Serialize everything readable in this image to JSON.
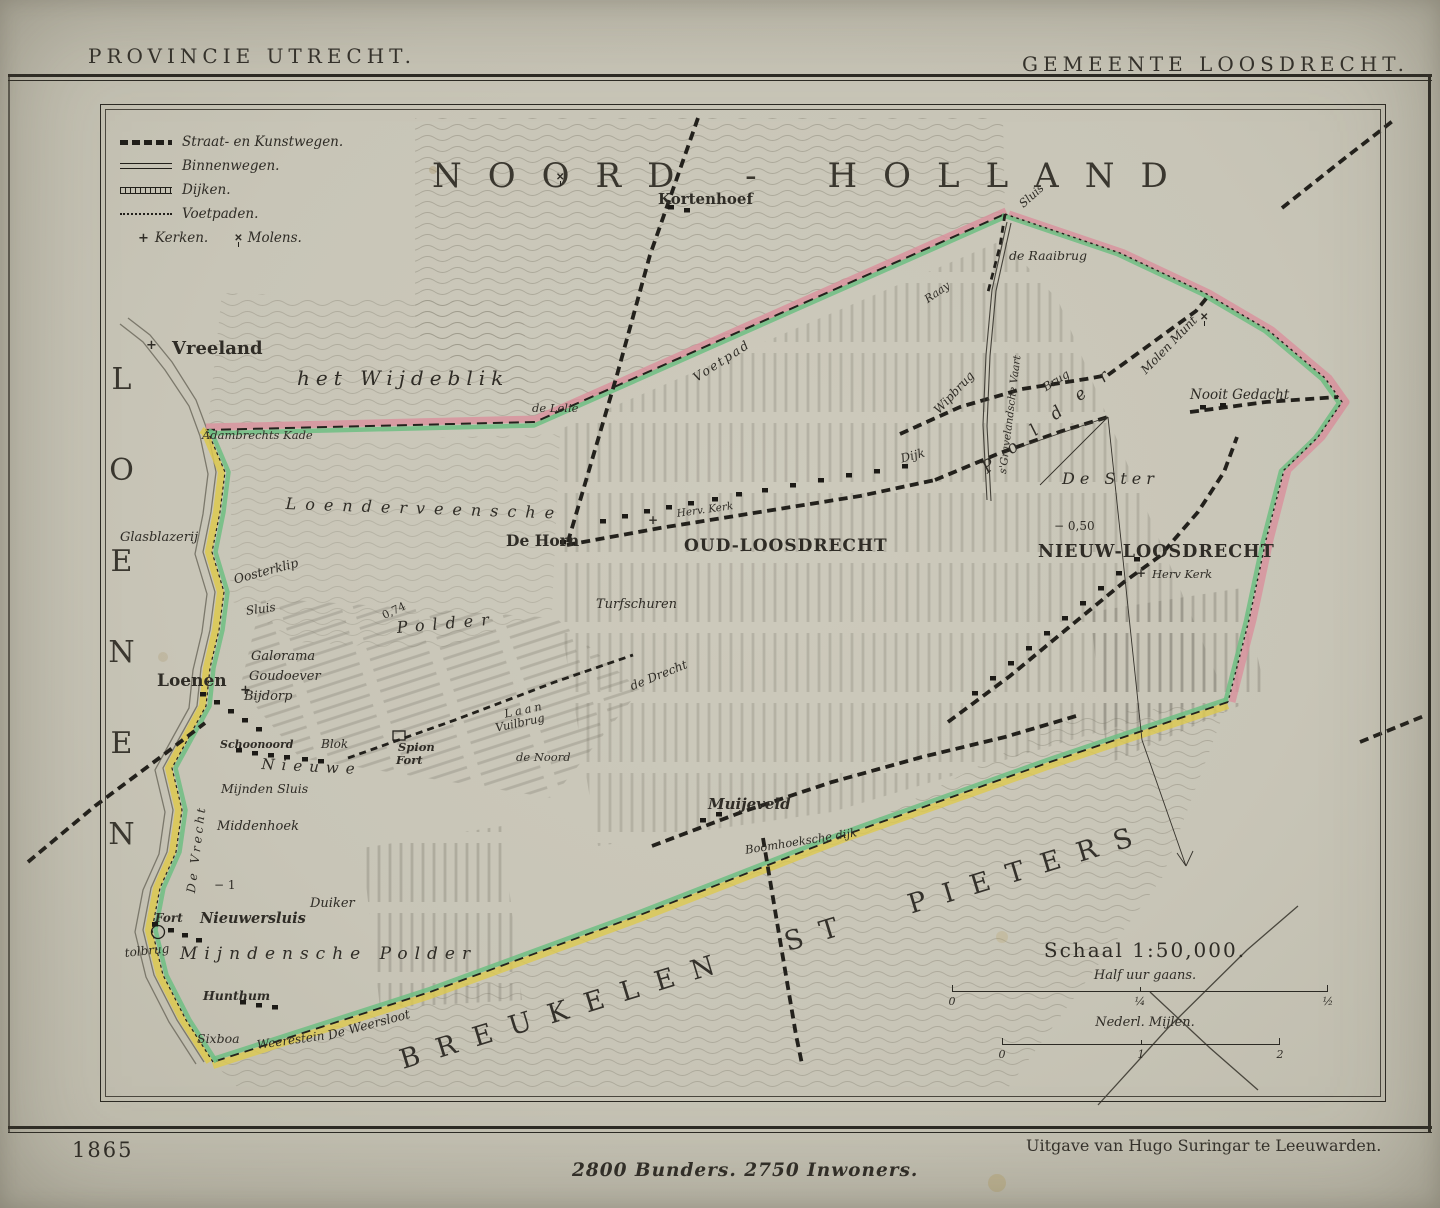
{
  "page": {
    "title_left": "PROVINCIE UTRECHT.",
    "title_right": "GEMEENTE LOOSDRECHT.",
    "year": "1865",
    "publisher": "Uitgave van Hugo Suringar te Leeuwarden.",
    "stats": "2800 Bunders. 2750 Inwoners."
  },
  "colors": {
    "paper": "#c8c5b7",
    "ink": "#2f2c26",
    "border_pink": "#d9909c",
    "border_green": "#6fbe82",
    "border_yellow": "#ddc94f"
  },
  "legend": {
    "items": [
      {
        "label": "Straat- en Kunstwegen."
      },
      {
        "label": "Binnenwegen."
      },
      {
        "label": "Dijken."
      },
      {
        "label": "Voetpaden."
      }
    ],
    "kerken_glyph": "+",
    "kerken_label": "Kerken.",
    "molens_glyph": "✕",
    "molens_label": "Molens."
  },
  "scale": {
    "title": "Schaal 1:50,000.",
    "bar1_label": "Half uur gaans.",
    "bar1_ticks": [
      "0",
      "¼",
      "½"
    ],
    "bar2_label": "Nederl. Mijlen.",
    "bar2_ticks": [
      "0",
      "1",
      "2"
    ]
  },
  "map": {
    "labels": [
      {
        "id": "noord-holland",
        "t": "NOORD - HOLLAND",
        "x": 432,
        "y": 156,
        "cls": "big"
      },
      {
        "id": "kortenhoef",
        "t": "Kortenhoef",
        "x": 658,
        "y": 190,
        "cls": "town",
        "fs": 15
      },
      {
        "id": "sluis-noord",
        "t": "Sluis",
        "x": 1016,
        "y": 200,
        "cls": "it",
        "fs": 11.5,
        "rot": -42
      },
      {
        "id": "de-raaibrug",
        "t": "de Raaibrug",
        "x": 1009,
        "y": 248,
        "cls": "it",
        "fs": 12.5
      },
      {
        "id": "raay",
        "t": "Raay",
        "x": 922,
        "y": 295,
        "cls": "it",
        "fs": 11,
        "rot": -35
      },
      {
        "id": "vreeland",
        "t": "Vreeland",
        "x": 172,
        "y": 338,
        "cls": "town",
        "fs": 18
      },
      {
        "id": "het-wijdeblik",
        "t": "het Wijdeblik",
        "x": 297,
        "y": 366,
        "cls": "region",
        "fs": 20,
        "ls": 6
      },
      {
        "id": "adambrechts-kade",
        "t": "Adambrechts Kade",
        "x": 202,
        "y": 428,
        "cls": "it",
        "fs": 11.5
      },
      {
        "id": "de-lelie",
        "t": "de Lelie",
        "x": 532,
        "y": 401,
        "cls": "it",
        "fs": 11.5
      },
      {
        "id": "voetpad",
        "t": "Voetpad",
        "x": 690,
        "y": 372,
        "cls": "it",
        "fs": 12.5,
        "ls": 2,
        "rot": -33
      },
      {
        "id": "wipbrug",
        "t": "Wipbrug",
        "x": 931,
        "y": 407,
        "cls": "it",
        "fs": 12,
        "rot": -47
      },
      {
        "id": "gravelandsche-vaart",
        "t": "s'Gravelandsche Vaart",
        "x": 997,
        "y": 473,
        "cls": "it",
        "fs": 10.5,
        "rot": -83
      },
      {
        "id": "brug",
        "t": "Brug",
        "x": 1040,
        "y": 382,
        "cls": "it",
        "fs": 11.5,
        "rot": -32
      },
      {
        "id": "molen-munt",
        "t": "Molen Munt",
        "x": 1138,
        "y": 367,
        "cls": "it",
        "fs": 12,
        "rot": -46
      },
      {
        "id": "polder-oost",
        "t": "Polder",
        "x": 978,
        "y": 462,
        "cls": "region",
        "fs": 17,
        "ls": 20,
        "rot": -38
      },
      {
        "id": "nooit-gedacht",
        "t": "Nooit Gedacht",
        "x": 1190,
        "y": 387,
        "cls": "it",
        "fs": 13.5
      },
      {
        "id": "de-ster",
        "t": "De Ster",
        "x": 1062,
        "y": 469,
        "cls": "region",
        "fs": 16,
        "ls": 5
      },
      {
        "id": "min-050",
        "t": "− 0,50",
        "x": 1054,
        "y": 519,
        "cls": "",
        "fs": 12
      },
      {
        "id": "nieuw-loosdrecht",
        "t": "NIEUW-LOOSDRECHT",
        "x": 1038,
        "y": 542,
        "cls": "village",
        "fs": 17.5
      },
      {
        "id": "herv-kerk-nieuw",
        "t": "Herv Kerk",
        "x": 1152,
        "y": 567,
        "cls": "it",
        "fs": 11.5
      },
      {
        "id": "de-horn",
        "t": "De Horn",
        "x": 506,
        "y": 531,
        "cls": "town",
        "fs": 15.5
      },
      {
        "id": "herv-kerk-oud",
        "t": "Herv. Kerk",
        "x": 676,
        "y": 508,
        "cls": "it",
        "fs": 10.5,
        "rot": -8
      },
      {
        "id": "oud-loosdrecht",
        "t": "OUD-LOOSDRECHT",
        "x": 684,
        "y": 536,
        "cls": "village",
        "fs": 17
      },
      {
        "id": "turfschuren",
        "t": "Turfschuren",
        "x": 596,
        "y": 597,
        "cls": "it",
        "fs": 13
      },
      {
        "id": "loenen-groot",
        "t": "LOENEN",
        "x": 104,
        "y": 362,
        "cls": "vert"
      },
      {
        "id": "glasblazerij",
        "t": "Glasblazerij",
        "x": 120,
        "y": 530,
        "cls": "it",
        "fs": 13
      },
      {
        "id": "oosterklip",
        "t": "Oosterklip",
        "x": 232,
        "y": 572,
        "cls": "it",
        "fs": 12.5,
        "rot": -15
      },
      {
        "id": "loenderveensche",
        "t": "Loenderveensche",
        "x": 286,
        "y": 494,
        "cls": "region",
        "fs": 16,
        "ls": 9,
        "rot": 2
      },
      {
        "id": "d074",
        "t": "0,74",
        "x": 380,
        "y": 610,
        "cls": "",
        "fs": 11,
        "rot": -25
      },
      {
        "id": "polder-mid",
        "t": "Polder",
        "x": 396,
        "y": 618,
        "cls": "region",
        "fs": 16,
        "ls": 8,
        "rot": -5
      },
      {
        "id": "sluis-loenen",
        "t": "Sluis",
        "x": 245,
        "y": 604,
        "cls": "it",
        "fs": 12,
        "rot": -8
      },
      {
        "id": "galorama",
        "t": "Galorama",
        "x": 251,
        "y": 649,
        "cls": "it",
        "fs": 13
      },
      {
        "id": "goudoever",
        "t": "Goudoever",
        "x": 249,
        "y": 669,
        "cls": "it",
        "fs": 13
      },
      {
        "id": "bijdorp",
        "t": "Bijdorp",
        "x": 244,
        "y": 689,
        "cls": "it",
        "fs": 13
      },
      {
        "id": "loenen",
        "t": "Loenen",
        "x": 157,
        "y": 671,
        "cls": "town",
        "fs": 17
      },
      {
        "id": "schoonoord",
        "t": "Schoonoord",
        "x": 220,
        "y": 738,
        "cls": "town-i",
        "fs": 11
      },
      {
        "id": "blok",
        "t": "Blok",
        "x": 321,
        "y": 737,
        "cls": "it",
        "fs": 12
      },
      {
        "id": "spion",
        "t": "Spion",
        "x": 398,
        "y": 740,
        "cls": "town-i",
        "fs": 11.5
      },
      {
        "id": "fort-spion",
        "t": "Fort",
        "x": 396,
        "y": 753,
        "cls": "town-i",
        "fs": 11.5
      },
      {
        "id": "nieuwe",
        "t": "Nieuwe",
        "x": 262,
        "y": 755,
        "cls": "region",
        "fs": 15,
        "ls": 7,
        "rot": 3
      },
      {
        "id": "mijnden-sluis",
        "t": "Mijnden Sluis",
        "x": 221,
        "y": 781,
        "cls": "it",
        "fs": 12.5
      },
      {
        "id": "de-vrecht",
        "t": "De Vrecht",
        "x": 184,
        "y": 892,
        "cls": "it",
        "fs": 12,
        "ls": 3,
        "rot": -83
      },
      {
        "id": "middenhoek",
        "t": "Middenhoek",
        "x": 217,
        "y": 819,
        "cls": "it",
        "fs": 13
      },
      {
        "id": "min-1",
        "t": "− 1",
        "x": 214,
        "y": 878,
        "cls": "",
        "fs": 12
      },
      {
        "id": "duiker",
        "t": "Duiker",
        "x": 310,
        "y": 896,
        "cls": "it",
        "fs": 13
      },
      {
        "id": "fort-nieuwersluis",
        "t": "Fort",
        "x": 155,
        "y": 911,
        "cls": "town-i",
        "fs": 12
      },
      {
        "id": "nieuwersluis",
        "t": "Nieuwersluis",
        "x": 200,
        "y": 910,
        "cls": "town-i",
        "fs": 14.5
      },
      {
        "id": "tolbrug",
        "t": "tolbrug",
        "x": 124,
        "y": 946,
        "cls": "it",
        "fs": 12,
        "rot": -6
      },
      {
        "id": "mijndensche-polder",
        "t": "Mijndensche Polder",
        "x": 180,
        "y": 944,
        "cls": "region",
        "fs": 17,
        "ls": 7
      },
      {
        "id": "hunthum",
        "t": "Hunthum",
        "x": 203,
        "y": 988,
        "cls": "town-i",
        "fs": 12.5
      },
      {
        "id": "sixboa",
        "t": "Sixboa",
        "x": 197,
        "y": 1031,
        "cls": "it",
        "fs": 12.5
      },
      {
        "id": "weerestein",
        "t": "Weerestein",
        "x": 256,
        "y": 1038,
        "cls": "it",
        "fs": 12,
        "rot": -8
      },
      {
        "id": "de-weersloot",
        "t": "De Weersloot",
        "x": 326,
        "y": 1028,
        "cls": "it",
        "fs": 12.5,
        "rot": -15
      },
      {
        "id": "breukelen-st-pieters",
        "t": "BREUKELEN ST PIETERS",
        "x": 396,
        "y": 1046,
        "cls": "giant",
        "rot": -17
      },
      {
        "id": "muijeveld",
        "t": "Muijeveld",
        "x": 708,
        "y": 795,
        "cls": "town-i",
        "fs": 15
      },
      {
        "id": "boomhoeksche-dijk",
        "t": "Boomhoeksche dijk",
        "x": 744,
        "y": 843,
        "cls": "it",
        "fs": 11.5,
        "rot": -9
      },
      {
        "id": "de-drecht",
        "t": "de Drecht",
        "x": 628,
        "y": 680,
        "cls": "it",
        "fs": 12,
        "rot": -22
      },
      {
        "id": "laan",
        "t": "Laan",
        "x": 503,
        "y": 707,
        "cls": "it",
        "fs": 11.5,
        "ls": 3,
        "rot": -12
      },
      {
        "id": "vuilbrug",
        "t": "Vuilbrug",
        "x": 494,
        "y": 721,
        "cls": "it",
        "fs": 11.5,
        "rot": -12
      },
      {
        "id": "de-noord",
        "t": "de Noord",
        "x": 516,
        "y": 750,
        "cls": "it",
        "fs": 11.5
      },
      {
        "id": "dijk",
        "t": "Dijk",
        "x": 899,
        "y": 452,
        "cls": "it",
        "fs": 12,
        "rot": -15
      }
    ],
    "symbols": [
      {
        "id": "church-vreeland",
        "g": "+",
        "x": 146,
        "y": 338,
        "fs": 13
      },
      {
        "id": "church-loenen",
        "g": "+",
        "x": 240,
        "y": 683,
        "fs": 13
      },
      {
        "id": "church-oud-loosdrecht",
        "g": "+",
        "x": 648,
        "y": 513,
        "fs": 12
      },
      {
        "id": "church-nieuw-loosdrecht",
        "g": "+",
        "x": 1136,
        "y": 566,
        "fs": 12
      },
      {
        "id": "mill-kortenhoef",
        "g": "✕",
        "x": 556,
        "y": 172,
        "fs": 10,
        "cls": "mill"
      },
      {
        "id": "mill-munt",
        "g": "✕",
        "x": 1200,
        "y": 312,
        "fs": 10,
        "cls": "mill"
      }
    ]
  }
}
